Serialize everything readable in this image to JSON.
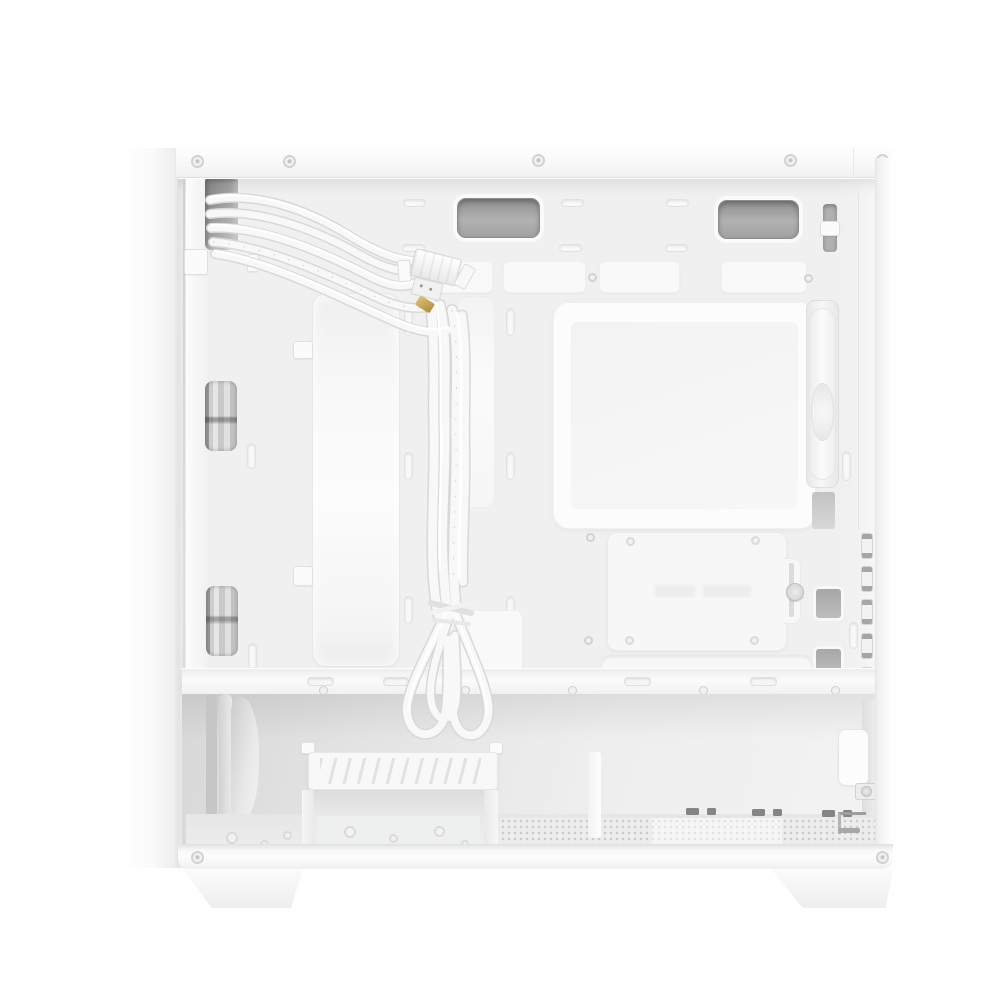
{
  "meta": {
    "title": "White micro tower PC case, side panel removed, interior view",
    "image_type": "product-photo",
    "background": "#ffffff"
  },
  "palette": {
    "case_white": "#f7f7f7",
    "panel_gray": "#f0f0f0",
    "seam_gray": "#d6d6d6",
    "grommet_gray": "#a9a9a9",
    "cutout_dark": "#8a8a8a",
    "mesh_dot": "#cbcbcb",
    "cable_white": "#f8f8f8",
    "usb_gold": "#c9a85c"
  },
  "parts": {
    "front_panel": "Front panel (outer edge)",
    "top_rail": "Top frame rail with rivets",
    "rear_panel": "Rear panel edge",
    "interior": "Motherboard tray interior",
    "cable_cutout": "Top front cable pass-through",
    "fan_window_top": "Front fan cutout (upper)",
    "fan_window_bottom": "Front fan cutout (lower)",
    "radiator_bracket": "Front radiator / fan bracket",
    "cable_bundle": "White front-panel cable bundle",
    "usb_connector": "Front panel USB connector block",
    "grommet": "Top cable grommet",
    "window_panel": "Motherboard tray window panel",
    "ssd_bracket": "2.5-inch SSD mounting bracket with thumbscrew",
    "routing_slot": "Cable routing slot",
    "rear_fan": "Rear exhaust fan (edge view)",
    "expansion_latches": "Expansion slot latches",
    "psu_shroud": "Power supply shroud divider",
    "drive_cage": "Hard drive cage",
    "bottom_mesh": "Bottom dust filter mesh",
    "bottom_rail": "Bottom frame rail",
    "foot_left": "Case foot (front)",
    "foot_right": "Case foot (rear)",
    "psu_bracket": "PSU mounting bracket",
    "front_fans_stack": "Front intake fans (edge view)"
  }
}
